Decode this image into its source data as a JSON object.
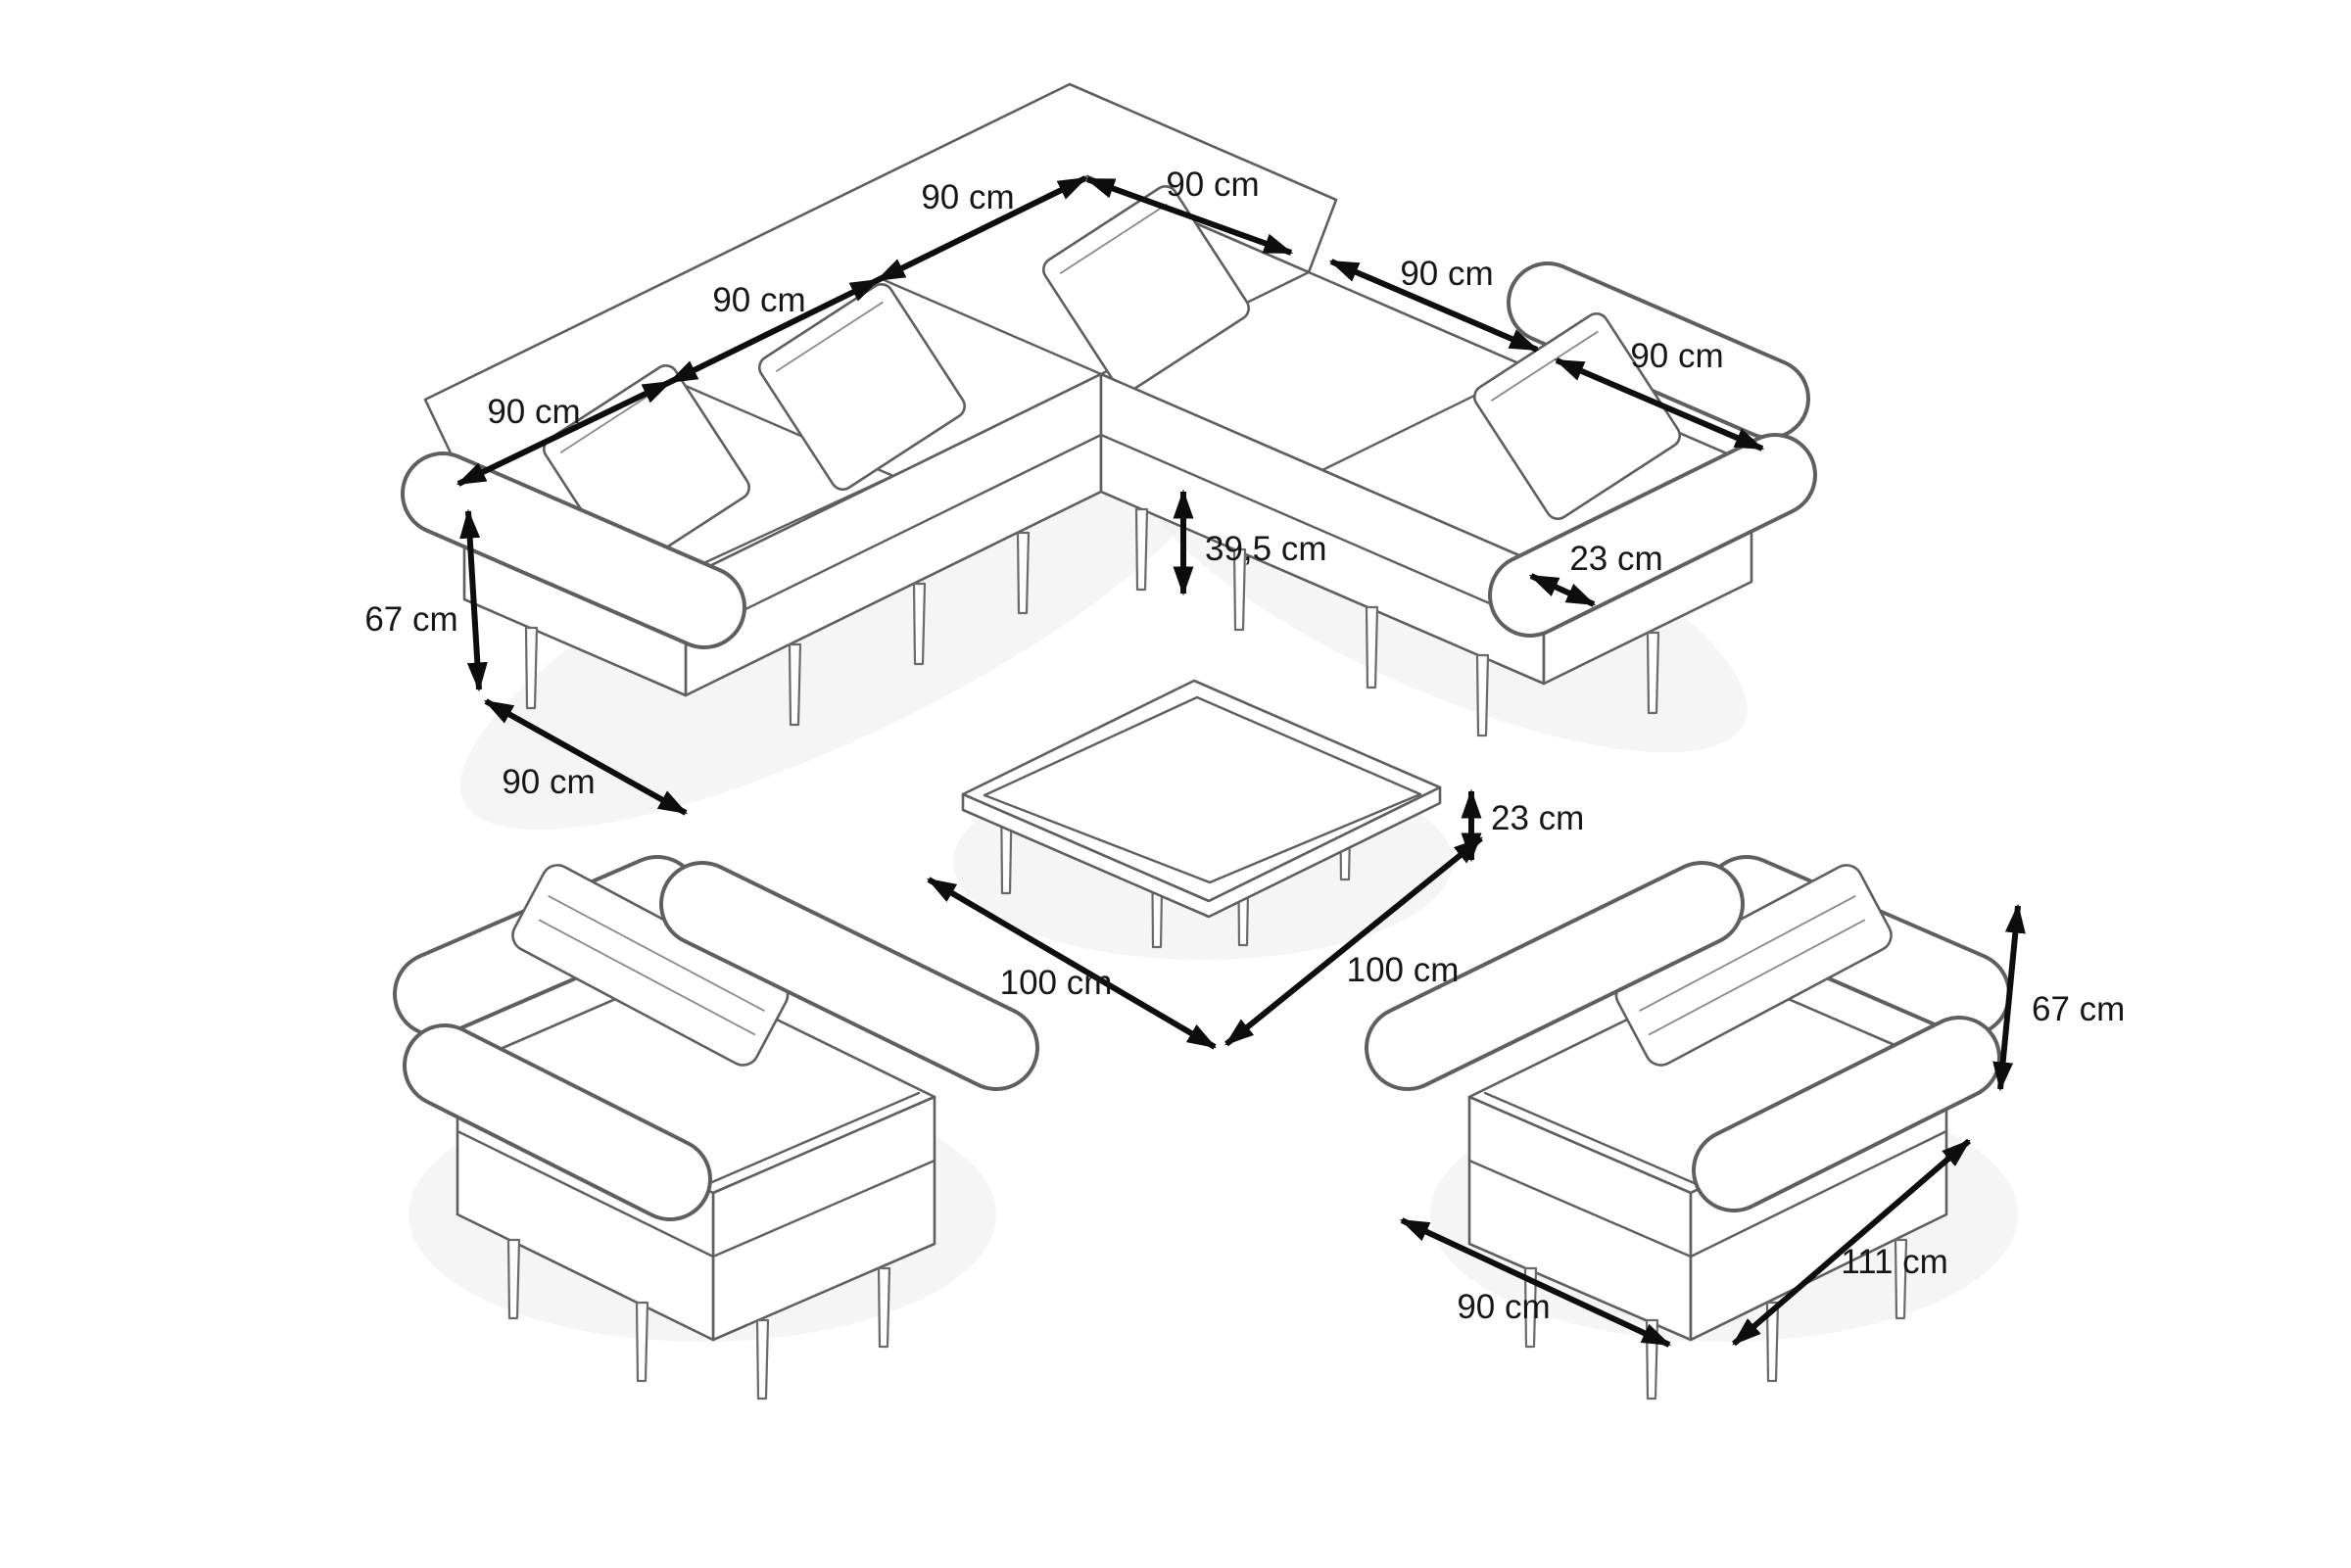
{
  "colors": {
    "background": "#ffffff",
    "outline": "#5f5f5f",
    "dimension_arrow": "#0d0d0d",
    "dimension_text": "#161616",
    "shadow": "#ededed"
  },
  "dimensions": {
    "sofa": {
      "back_left": [
        "90 cm",
        "90 cm",
        "90 cm"
      ],
      "back_right": [
        "90 cm",
        "90 cm",
        "90 cm"
      ],
      "height": "67 cm",
      "depth": "90 cm",
      "seat_height": "39,5 cm",
      "armrest_width": "23 cm"
    },
    "table": {
      "height": "23 cm",
      "side_left": "100 cm",
      "side_right": "100 cm"
    },
    "armchair": {
      "height": "67 cm",
      "depth": "111 cm",
      "width": "90 cm"
    }
  }
}
